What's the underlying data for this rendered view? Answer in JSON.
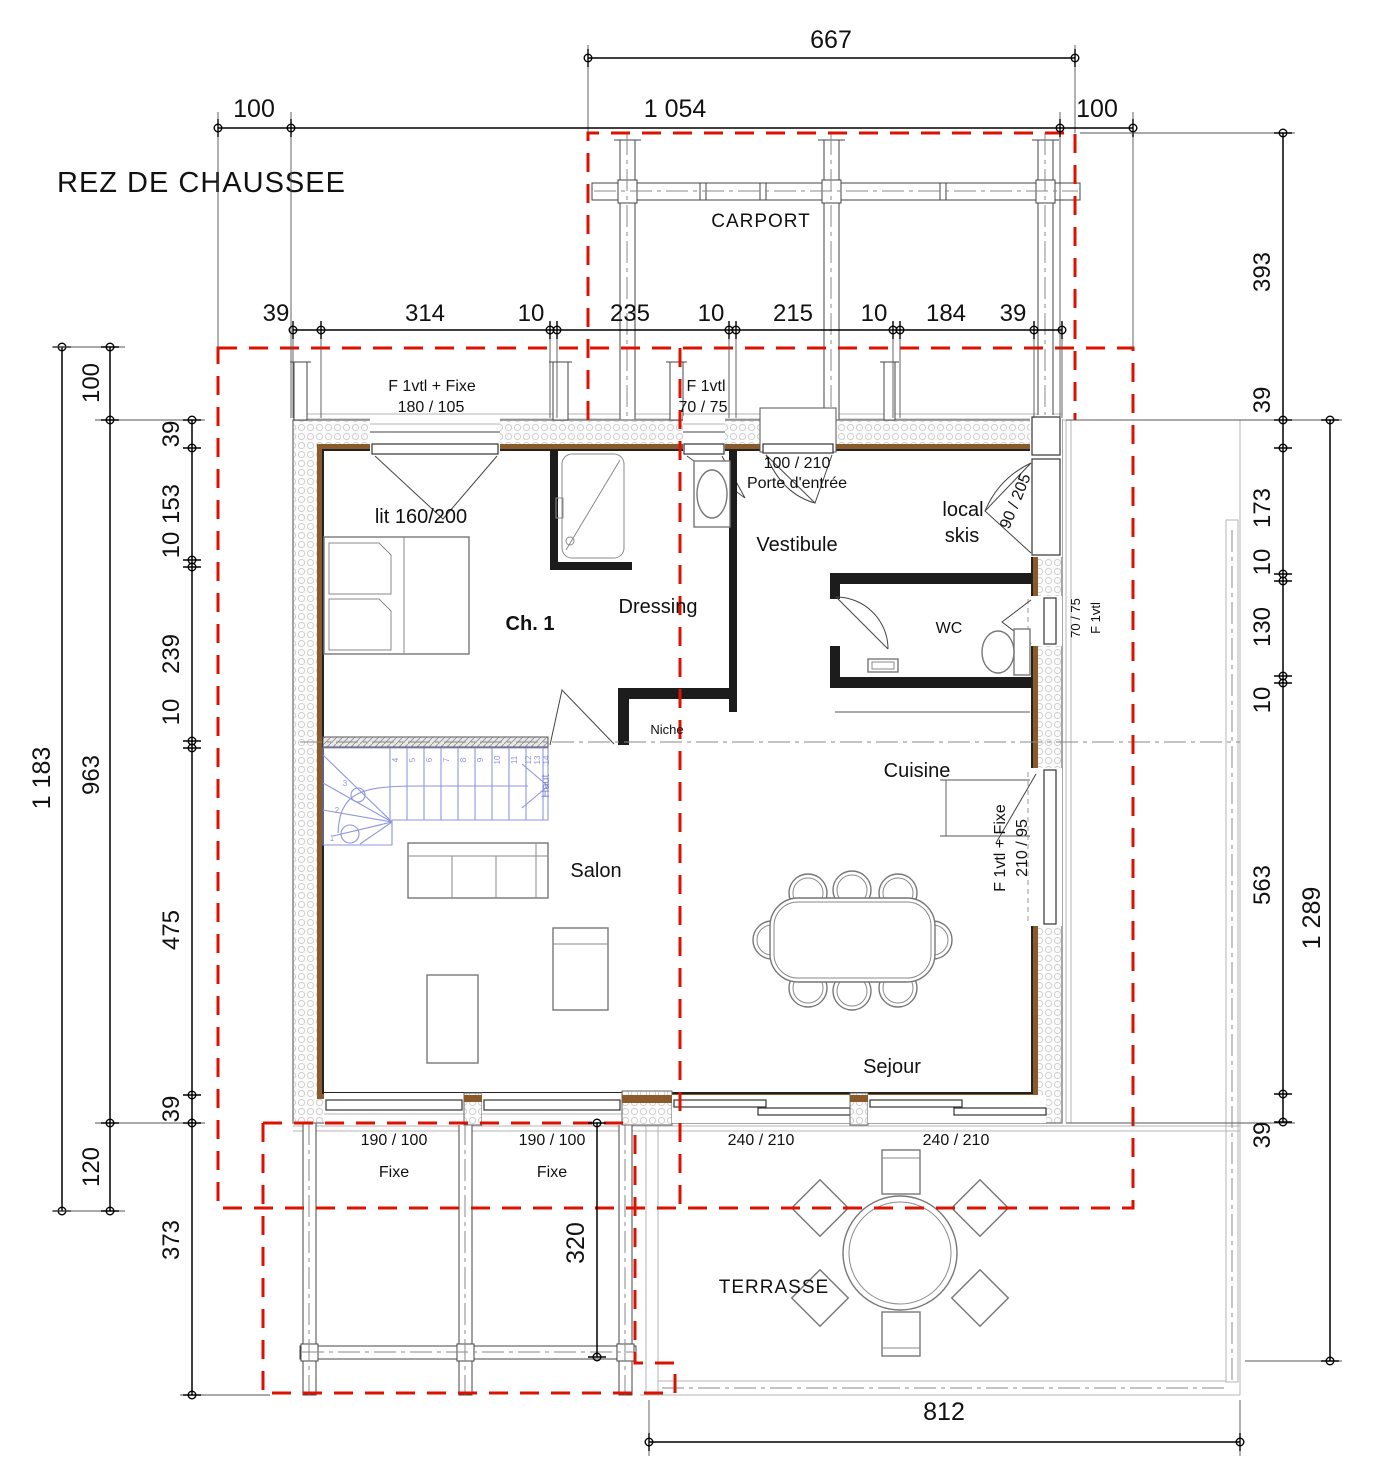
{
  "title": "REZ DE CHAUSSEE",
  "rooms": {
    "carport": "CARPORT",
    "ch1": "Ch. 1",
    "bed": "lit 160/200",
    "dressing": "Dressing",
    "vestibule": "Vestibule",
    "local_skis_1": "local",
    "local_skis_2": "skis",
    "wc": "WC",
    "cuisine": "Cuisine",
    "salon": "Salon",
    "sejour": "Sejour",
    "terrasse": "TERRASSE",
    "niche": "Niche"
  },
  "stairs": {
    "up": "Haut",
    "steps": [
      "1",
      "2",
      "3",
      "4",
      "5",
      "6",
      "7",
      "8",
      "9",
      "10",
      "11",
      "12",
      "13",
      "14"
    ]
  },
  "openings": {
    "ch1_window": [
      "F 1vtl + Fixe",
      "180 / 105"
    ],
    "dressing_window": [
      "F 1vtl",
      "70 / 75"
    ],
    "entrance": [
      "100 / 210",
      "Porte d'entrée"
    ],
    "ski_door": "90 / 205",
    "wc_window": [
      "70 / 75",
      "F 1vtl"
    ],
    "kitchen_window": [
      "F 1vtl + Fixe",
      "210 / 95"
    ],
    "salon_window_1": [
      "190 / 100",
      "Fixe"
    ],
    "salon_window_2": [
      "190 / 100",
      "Fixe"
    ],
    "sejour_bay_1": "240 / 210",
    "sejour_bay_2": "240 / 210"
  },
  "dims": {
    "carport_width": "667",
    "top_row": [
      "100",
      "1 054",
      "100"
    ],
    "top_chain": [
      "39",
      "314",
      "10",
      "235",
      "10",
      "215",
      "10",
      "184",
      "39"
    ],
    "left_total": "1 183",
    "left_mid": [
      "100",
      "963",
      "120"
    ],
    "left_chain": [
      "39",
      "153",
      "10",
      "239",
      "10",
      "475",
      "39",
      "373"
    ],
    "right_total": "1 289",
    "right_chain": [
      "393",
      "39",
      "173",
      "10",
      "130",
      "10",
      "563",
      "39"
    ],
    "terrace_width": "812",
    "terrace_depth": "320"
  },
  "colors": {
    "red": "#dd1100",
    "wood": "#8a5a2b",
    "stair_blue": "#8f95dd"
  }
}
